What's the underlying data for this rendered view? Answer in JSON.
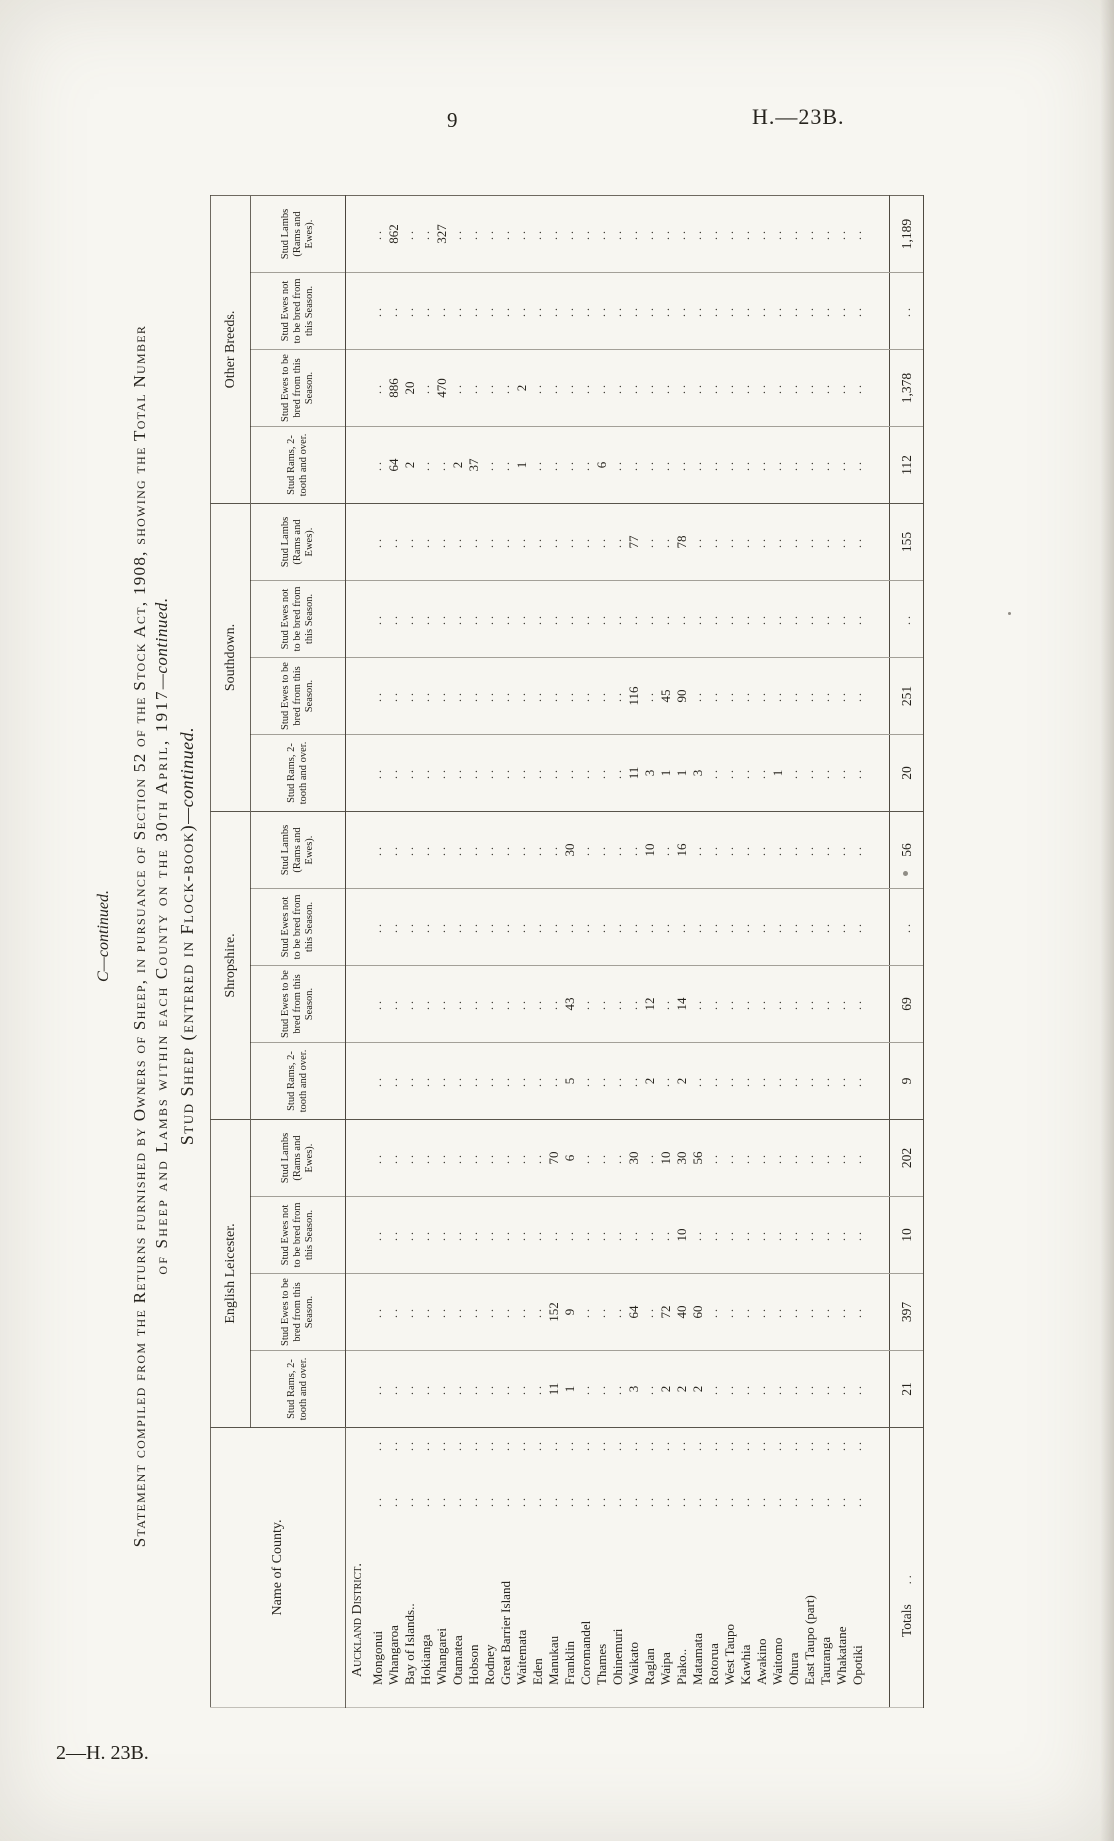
{
  "page": {
    "page_number": "9",
    "paper_ref": "H.—23B.",
    "footer_ref": "2—H. 23B.",
    "title_c": "C—continued.",
    "title_line1": "Statement compiled from the Returns furnished by Owners of Sheep, in pursuance of Section 52 of the Stock Act, 1908, showing the Total Number",
    "title_line2": "of Sheep and Lambs within each County on the 30th April, 1917",
    "title_line2_cont": "—continued.",
    "subtitle": "Stud Sheep (entered in Flock-book)",
    "subtitle_cont": "—continued."
  },
  "table": {
    "name_header": "Name of County.",
    "groups": [
      "English Leicester.",
      "Shropshire.",
      "Southdown.",
      "Other Breeds."
    ],
    "sub_headers": [
      "Stud Rams, 2-tooth and over.",
      "Stud Ewes to be bred from this Season.",
      "Stud Ewes not to be bred from this Season.",
      "Stud Lambs (Rams and Ewes)."
    ],
    "district_header": "Auckland District.",
    "empty_cell": "..",
    "totals_label": "Totals",
    "rows": [
      {
        "name": "Mongonui",
        "values": [
          "..",
          "..",
          "..",
          "..",
          "..",
          "..",
          "..",
          "..",
          "..",
          "..",
          "..",
          "..",
          "..",
          "..",
          "..",
          ".."
        ]
      },
      {
        "name": "Whangaroa",
        "values": [
          "..",
          "..",
          "..",
          "..",
          "..",
          "..",
          "..",
          "..",
          "..",
          "..",
          "..",
          "..",
          "64",
          "886",
          "..",
          "862"
        ]
      },
      {
        "name": "Bay of Islands..",
        "values": [
          "..",
          "..",
          "..",
          "..",
          "..",
          "..",
          "..",
          "..",
          "..",
          "..",
          "..",
          "..",
          "2",
          "20",
          "..",
          ".."
        ]
      },
      {
        "name": "Hokianga",
        "values": [
          "..",
          "..",
          "..",
          "..",
          "..",
          "..",
          "..",
          "..",
          "..",
          "..",
          "..",
          "..",
          "..",
          "..",
          "..",
          ".."
        ]
      },
      {
        "name": "Whangarei",
        "values": [
          "..",
          "..",
          "..",
          "..",
          "..",
          "..",
          "..",
          "..",
          "..",
          "..",
          "..",
          "..",
          "..",
          "470",
          "..",
          "327"
        ]
      },
      {
        "name": "Otamatea",
        "values": [
          "..",
          "..",
          "..",
          "..",
          "..",
          "..",
          "..",
          "..",
          "..",
          "..",
          "..",
          "..",
          "2",
          "..",
          "..",
          ".."
        ]
      },
      {
        "name": "Hobson",
        "values": [
          "..",
          "..",
          "..",
          "..",
          "..",
          "..",
          "..",
          "..",
          "..",
          "..",
          "..",
          "..",
          "37",
          "..",
          "..",
          ".."
        ]
      },
      {
        "name": "Rodney",
        "values": [
          "..",
          "..",
          "..",
          "..",
          "..",
          "..",
          "..",
          "..",
          "..",
          "..",
          "..",
          "..",
          "..",
          "..",
          "..",
          ".."
        ]
      },
      {
        "name": "Great Barrier Island",
        "values": [
          "..",
          "..",
          "..",
          "..",
          "..",
          "..",
          "..",
          "..",
          "..",
          "..",
          "..",
          "..",
          "..",
          "..",
          "..",
          ".."
        ]
      },
      {
        "name": "Waitemata",
        "values": [
          "..",
          "..",
          "..",
          "..",
          "..",
          "..",
          "..",
          "..",
          "..",
          "..",
          "..",
          "..",
          "1",
          "2",
          "..",
          ".."
        ]
      },
      {
        "name": "Eden",
        "values": [
          "..",
          "..",
          "..",
          "..",
          "..",
          "..",
          "..",
          "..",
          "..",
          "..",
          "..",
          "..",
          "..",
          "..",
          "..",
          ".."
        ]
      },
      {
        "name": "Manukau",
        "values": [
          "11",
          "152",
          "..",
          "70",
          "..",
          "..",
          "..",
          "..",
          "..",
          "..",
          "..",
          "..",
          "..",
          "..",
          "..",
          ".."
        ]
      },
      {
        "name": "Franklin",
        "values": [
          "1",
          "9",
          "..",
          "6",
          "5",
          "43",
          "..",
          "30",
          "..",
          "..",
          "..",
          "..",
          "..",
          "..",
          "..",
          ".."
        ]
      },
      {
        "name": "Coromandel",
        "values": [
          "..",
          "..",
          "..",
          "..",
          "..",
          "..",
          "..",
          "..",
          "..",
          "..",
          "..",
          "..",
          "..",
          "..",
          "..",
          ".."
        ]
      },
      {
        "name": "Thames",
        "values": [
          "..",
          "..",
          "..",
          "..",
          "..",
          "..",
          "..",
          "..",
          "..",
          "..",
          "..",
          "..",
          "6",
          "..",
          "..",
          ".."
        ]
      },
      {
        "name": "Ohinemuri",
        "values": [
          "..",
          "..",
          "..",
          "..",
          "..",
          "..",
          "..",
          "..",
          "..",
          "..",
          "..",
          "..",
          "..",
          "..",
          "..",
          ".."
        ]
      },
      {
        "name": "Waikato",
        "values": [
          "3",
          "64",
          "..",
          "30",
          "..",
          "..",
          "..",
          "..",
          "11",
          "116",
          "..",
          "77",
          "..",
          "..",
          "..",
          ".."
        ]
      },
      {
        "name": "Raglan",
        "values": [
          "..",
          "..",
          "..",
          "..",
          "2",
          "12",
          "..",
          "10",
          "3",
          "..",
          "..",
          "..",
          "..",
          "..",
          "..",
          ".."
        ]
      },
      {
        "name": "Waipa",
        "values": [
          "2",
          "72",
          "..",
          "10",
          "..",
          "..",
          "..",
          "..",
          "1",
          "45",
          "..",
          "..",
          "..",
          "..",
          "..",
          ".."
        ]
      },
      {
        "name": "Piako..",
        "values": [
          "2",
          "40",
          "10",
          "30",
          "2",
          "14",
          "..",
          "16",
          "1",
          "90",
          "..",
          "78",
          "..",
          "..",
          "..",
          ".."
        ]
      },
      {
        "name": "Matamata",
        "values": [
          "2",
          "60",
          "..",
          "56",
          "..",
          "..",
          "..",
          "..",
          "3",
          "..",
          "..",
          "..",
          "..",
          "..",
          "..",
          ".."
        ]
      },
      {
        "name": "Rotorua",
        "values": [
          "..",
          "..",
          "..",
          "..",
          "..",
          "..",
          "..",
          "..",
          "..",
          "..",
          "..",
          "..",
          "..",
          "..",
          "..",
          ".."
        ]
      },
      {
        "name": "West Taupo",
        "values": [
          "..",
          "..",
          "..",
          "..",
          "..",
          "..",
          "..",
          "..",
          "..",
          "..",
          "..",
          "..",
          "..",
          "..",
          "..",
          ".."
        ]
      },
      {
        "name": "Kawhia",
        "values": [
          "..",
          "..",
          "..",
          "..",
          "..",
          "..",
          "..",
          "..",
          "..",
          "..",
          "..",
          "..",
          "..",
          "..",
          "..",
          ".."
        ]
      },
      {
        "name": "Awakino",
        "values": [
          "..",
          "..",
          "..",
          "..",
          "..",
          "..",
          "..",
          "..",
          "..",
          "..",
          "..",
          "..",
          "..",
          "..",
          "..",
          ".."
        ]
      },
      {
        "name": "Waitomo",
        "values": [
          "..",
          "..",
          "..",
          "..",
          "..",
          "..",
          "..",
          "..",
          "1",
          "..",
          "..",
          "..",
          "..",
          "..",
          "..",
          ".."
        ]
      },
      {
        "name": "Ohura",
        "values": [
          "..",
          "..",
          "..",
          "..",
          "..",
          "..",
          "..",
          "..",
          "..",
          "..",
          "..",
          "..",
          "..",
          "..",
          "..",
          ".."
        ]
      },
      {
        "name": "East Taupo (part)",
        "values": [
          "..",
          "..",
          "..",
          "..",
          "..",
          "..",
          "..",
          "..",
          "..",
          "..",
          "..",
          "..",
          "..",
          "..",
          "..",
          ".."
        ]
      },
      {
        "name": "Tauranga",
        "values": [
          "..",
          "..",
          "..",
          "..",
          "..",
          "..",
          "..",
          "..",
          "..",
          "..",
          "..",
          "..",
          "..",
          "..",
          "..",
          ".."
        ]
      },
      {
        "name": "Whakatane",
        "values": [
          "..",
          "..",
          "..",
          "..",
          "..",
          "..",
          "..",
          "..",
          "..",
          "..",
          "..",
          "..",
          "..",
          "..",
          "..",
          ".."
        ]
      },
      {
        "name": "Opotiki",
        "values": [
          "..",
          "..",
          "..",
          "..",
          "..",
          "..",
          "..",
          "..",
          "..",
          "..",
          "..",
          "..",
          "..",
          "..",
          "..",
          ".."
        ]
      }
    ],
    "totals": [
      "21",
      "397",
      "10",
      "202",
      "9",
      "69",
      "..",
      "56",
      "20",
      "251",
      "..",
      "155",
      "112",
      "1,378",
      "..",
      "1,189"
    ]
  }
}
